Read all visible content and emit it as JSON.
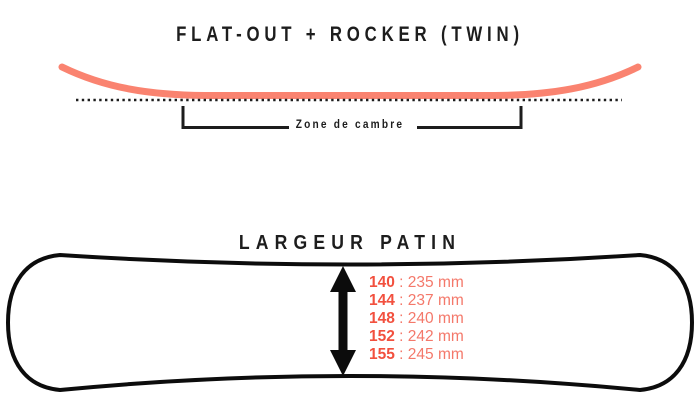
{
  "colors": {
    "accent": "#FA8370",
    "accent_strong": "#F2503E",
    "accent_soft": "#F4786A",
    "ink": "#1D1D1D",
    "outline": "#0C0C0C"
  },
  "profile": {
    "title": "FLAT-OUT + ROCKER (TWIN)",
    "camber_zone_label": "Zone de cambre"
  },
  "width": {
    "title": "LARGEUR PATIN",
    "separator": " : ",
    "rows": [
      {
        "size": "140",
        "value": "235 mm"
      },
      {
        "size": "144",
        "value": "237 mm"
      },
      {
        "size": "148",
        "value": "240 mm"
      },
      {
        "size": "152",
        "value": "242 mm"
      },
      {
        "size": "155",
        "value": "245 mm"
      }
    ]
  }
}
